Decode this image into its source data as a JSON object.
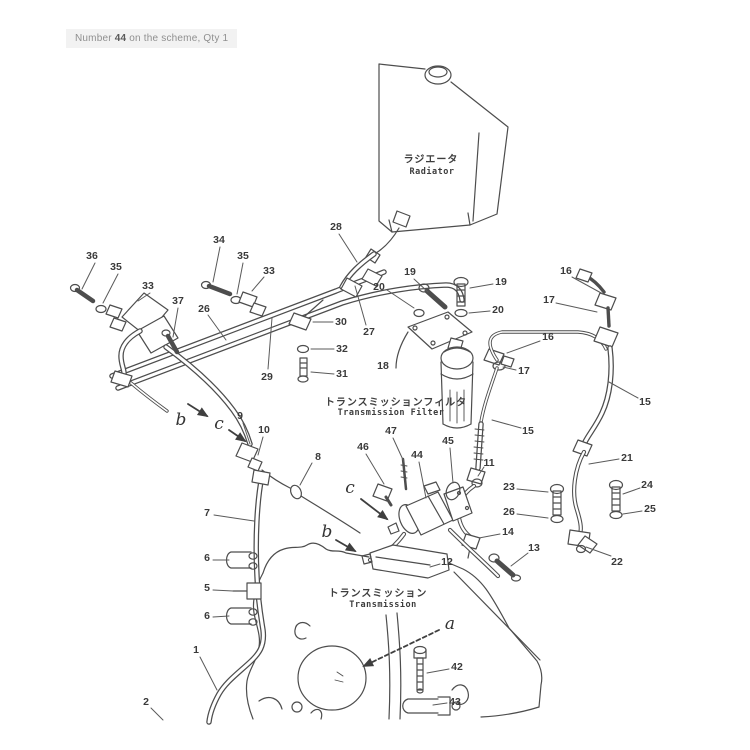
{
  "header": {
    "t1": "Number ",
    "t2": "44",
    "t3": " on the scheme, Qty 1"
  },
  "labels": {
    "radiator_jp": "ラジエータ",
    "radiator_en": "Radiator",
    "filter_jp": "トランスミッションフィルタ",
    "filter_en": "Transmission Filter",
    "transmission_jp": "トランスミッション",
    "transmission_en": "Transmission"
  },
  "colors": {
    "ink": "#4d4d4d",
    "paper": "#ffffff",
    "note_bg": "#f2f2f2"
  },
  "callouts": [
    {
      "t": "36",
      "x": 92,
      "y": 256,
      "lx": 95,
      "ly": 263,
      "ex": 82,
      "ey": 289
    },
    {
      "t": "35",
      "x": 116,
      "y": 267,
      "lx": 118,
      "ly": 274,
      "ex": 103,
      "ey": 303
    },
    {
      "t": "33",
      "x": 148,
      "y": 286,
      "lx": 150,
      "ly": 293,
      "ex": 138,
      "ey": 301
    },
    {
      "t": "37",
      "x": 178,
      "y": 301,
      "lx": 178,
      "ly": 308,
      "ex": 173,
      "ey": 337
    },
    {
      "t": "26",
      "x": 204,
      "y": 309,
      "lx": 208,
      "ly": 315,
      "ex": 226,
      "ey": 340
    },
    {
      "t": "34",
      "x": 219,
      "y": 240,
      "lx": 220,
      "ly": 247,
      "ex": 213,
      "ey": 282
    },
    {
      "t": "35",
      "x": 243,
      "y": 256,
      "lx": 243,
      "ly": 263,
      "ex": 237,
      "ey": 294
    },
    {
      "t": "33",
      "x": 269,
      "y": 271,
      "lx": 264,
      "ly": 277,
      "ex": 252,
      "ey": 291
    },
    {
      "t": "28",
      "x": 336,
      "y": 227,
      "lx": 339,
      "ly": 234,
      "ex": 357,
      "ey": 262
    },
    {
      "t": "20",
      "x": 379,
      "y": 287,
      "lx": 387,
      "ly": 290,
      "ex": 414,
      "ey": 308
    },
    {
      "t": "19",
      "x": 410,
      "y": 272,
      "lx": 414,
      "ly": 279,
      "ex": 428,
      "ey": 292
    },
    {
      "t": "19",
      "x": 501,
      "y": 282,
      "lx": 493,
      "ly": 284,
      "ex": 470,
      "ey": 288
    },
    {
      "t": "20",
      "x": 498,
      "y": 310,
      "lx": 490,
      "ly": 311,
      "ex": 469,
      "ey": 313
    },
    {
      "t": "16",
      "x": 566,
      "y": 271,
      "lx": 572,
      "ly": 277,
      "ex": 603,
      "ey": 294
    },
    {
      "t": "17",
      "x": 549,
      "y": 300,
      "lx": 556,
      "ly": 303,
      "ex": 597,
      "ey": 312
    },
    {
      "t": "30",
      "x": 341,
      "y": 322,
      "lx": 333,
      "ly": 322,
      "ex": 313,
      "ey": 322
    },
    {
      "t": "27",
      "x": 369,
      "y": 332,
      "lx": 366,
      "ly": 325,
      "ex": 355,
      "ey": 286
    },
    {
      "t": "32",
      "x": 342,
      "y": 349,
      "lx": 334,
      "ly": 349,
      "ex": 311,
      "ey": 349
    },
    {
      "t": "31",
      "x": 342,
      "y": 374,
      "lx": 334,
      "ly": 374,
      "ex": 311,
      "ey": 372
    },
    {
      "t": "29",
      "x": 267,
      "y": 377,
      "lx": 268,
      "ly": 369,
      "ex": 272,
      "ey": 318
    },
    {
      "t": "18",
      "x": 383,
      "y": 366
    },
    {
      "t": "16",
      "x": 548,
      "y": 337,
      "lx": 540,
      "ly": 341,
      "ex": 507,
      "ey": 353
    },
    {
      "t": "17",
      "x": 524,
      "y": 371,
      "lx": 516,
      "ly": 370,
      "ex": 503,
      "ey": 367
    },
    {
      "t": "15",
      "x": 645,
      "y": 402,
      "lx": 638,
      "ly": 398,
      "ex": 609,
      "ey": 382
    },
    {
      "t": "9",
      "x": 240,
      "y": 416,
      "lx": 243,
      "ly": 423,
      "ex": 250,
      "ey": 444
    },
    {
      "t": "10",
      "x": 264,
      "y": 430,
      "lx": 263,
      "ly": 437,
      "ex": 258,
      "ey": 455
    },
    {
      "t": "8",
      "x": 318,
      "y": 457,
      "lx": 312,
      "ly": 463,
      "ex": 300,
      "ey": 485
    },
    {
      "t": "46",
      "x": 363,
      "y": 447,
      "lx": 366,
      "ly": 454,
      "ex": 384,
      "ey": 484
    },
    {
      "t": "47",
      "x": 391,
      "y": 431,
      "lx": 393,
      "ly": 438,
      "ex": 404,
      "ey": 462
    },
    {
      "t": "44",
      "x": 417,
      "y": 455,
      "lx": 419,
      "ly": 462,
      "ex": 426,
      "ey": 498
    },
    {
      "t": "45",
      "x": 448,
      "y": 441,
      "lx": 450,
      "ly": 448,
      "ex": 453,
      "ey": 483
    },
    {
      "t": "11",
      "x": 489,
      "y": 463,
      "lx": 484,
      "ly": 467,
      "ex": 478,
      "ey": 476
    },
    {
      "t": "15",
      "x": 528,
      "y": 431,
      "lx": 521,
      "ly": 428,
      "ex": 492,
      "ey": 420
    },
    {
      "t": "21",
      "x": 627,
      "y": 458,
      "lx": 619,
      "ly": 459,
      "ex": 589,
      "ey": 464
    },
    {
      "t": "23",
      "x": 509,
      "y": 487,
      "lx": 517,
      "ly": 489,
      "ex": 548,
      "ey": 492
    },
    {
      "t": "24",
      "x": 647,
      "y": 485,
      "lx": 640,
      "ly": 488,
      "ex": 623,
      "ey": 494
    },
    {
      "t": "26",
      "x": 509,
      "y": 512,
      "lx": 517,
      "ly": 514,
      "ex": 548,
      "ey": 518
    },
    {
      "t": "25",
      "x": 650,
      "y": 509,
      "lx": 642,
      "ly": 511,
      "ex": 623,
      "ey": 514
    },
    {
      "t": "7",
      "x": 207,
      "y": 513,
      "lx": 214,
      "ly": 515,
      "ex": 254,
      "ey": 521
    },
    {
      "t": "14",
      "x": 508,
      "y": 532,
      "lx": 500,
      "ly": 534,
      "ex": 479,
      "ey": 538
    },
    {
      "t": "13",
      "x": 534,
      "y": 548,
      "lx": 528,
      "ly": 553,
      "ex": 511,
      "ey": 566
    },
    {
      "t": "22",
      "x": 617,
      "y": 562,
      "lx": 611,
      "ly": 556,
      "ex": 586,
      "ey": 547
    },
    {
      "t": "12",
      "x": 447,
      "y": 562,
      "lx": 440,
      "ly": 564,
      "ex": 430,
      "ey": 567
    },
    {
      "t": "6",
      "x": 207,
      "y": 558,
      "lx": 213,
      "ly": 560,
      "ex": 229,
      "ey": 560
    },
    {
      "t": "5",
      "x": 207,
      "y": 588,
      "lx": 213,
      "ly": 590,
      "ex": 233,
      "ey": 591
    },
    {
      "t": "6",
      "x": 207,
      "y": 616,
      "lx": 213,
      "ly": 617,
      "ex": 229,
      "ey": 616
    },
    {
      "t": "1",
      "x": 196,
      "y": 650,
      "lx": 200,
      "ly": 657,
      "ex": 217,
      "ey": 690
    },
    {
      "t": "42",
      "x": 457,
      "y": 667,
      "lx": 449,
      "ly": 669,
      "ex": 427,
      "ey": 673
    },
    {
      "t": "43",
      "x": 455,
      "y": 702,
      "lx": 447,
      "ly": 703,
      "ex": 433,
      "ey": 705
    },
    {
      "t": "2",
      "x": 146,
      "y": 702,
      "lx": 151,
      "ly": 708,
      "ex": 163,
      "ey": 720
    },
    {
      "t": "b",
      "letter": true,
      "x": 181,
      "y": 420,
      "lx": 188,
      "ly": 404,
      "ex": 207,
      "ey": 416,
      "arrow": true
    },
    {
      "t": "c",
      "letter": true,
      "x": 219,
      "y": 424,
      "lx": 229,
      "ly": 430,
      "ex": 245,
      "ey": 441,
      "arrow": true
    },
    {
      "t": "c",
      "letter": true,
      "x": 350,
      "y": 488,
      "lx": 361,
      "ly": 499,
      "ex": 387,
      "ey": 519,
      "arrow": true
    },
    {
      "t": "b",
      "letter": true,
      "x": 327,
      "y": 532,
      "lx": 336,
      "ly": 540,
      "ex": 355,
      "ey": 551,
      "arrow": true
    },
    {
      "t": "a",
      "letter": true,
      "x": 450,
      "y": 624,
      "lx": 439,
      "ly": 630,
      "ex": 364,
      "ey": 666,
      "arrow": true,
      "dashed": true
    }
  ]
}
